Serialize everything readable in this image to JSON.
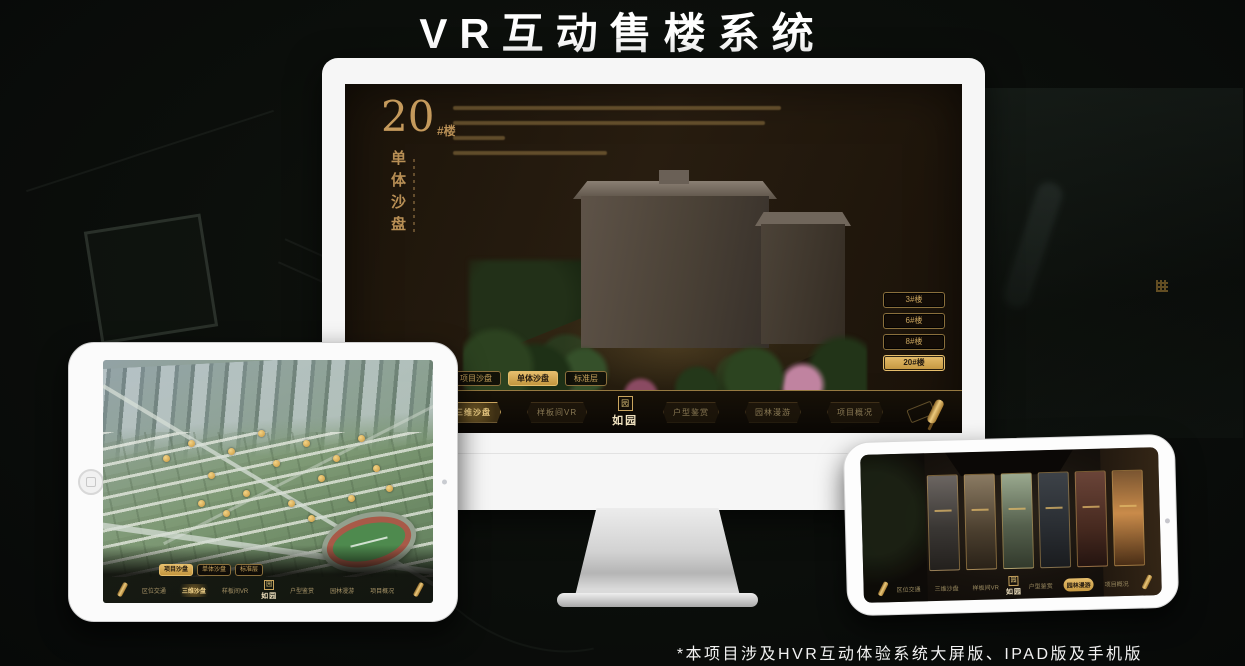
{
  "title": "VR互动售楼系统",
  "footnote": "*本项目涉及HVR互动体验系统大屏版、IPAD版及手机版",
  "logo": {
    "name": "如园",
    "seal": "园"
  },
  "menus": {
    "sub_tabs": [
      "项目沙盘",
      "单体沙盘",
      "标准层"
    ],
    "nav_items": [
      "区位交通",
      "三维沙盘",
      "样板间VR",
      "户型鉴赏",
      "园林漫游",
      "项目概况"
    ]
  },
  "desktop": {
    "hero_number": "20",
    "hero_unit": "#楼",
    "hero_title": "单体沙盘",
    "floor_buttons": [
      {
        "label": "3#楼",
        "active": false
      },
      {
        "label": "6#楼",
        "active": false
      },
      {
        "label": "8#楼",
        "active": false
      },
      {
        "label": "20#楼",
        "active": true
      }
    ],
    "active_sub_tab": 1,
    "active_nav_item": 1
  },
  "tablet": {
    "active_sub_tab": 0,
    "active_nav_item": 1
  },
  "phone": {
    "active_nav_item": 4
  },
  "colors": {
    "gold": "#c9a35f",
    "gold_bright": "#e2bb66",
    "screen_brown": "#241a0e"
  }
}
